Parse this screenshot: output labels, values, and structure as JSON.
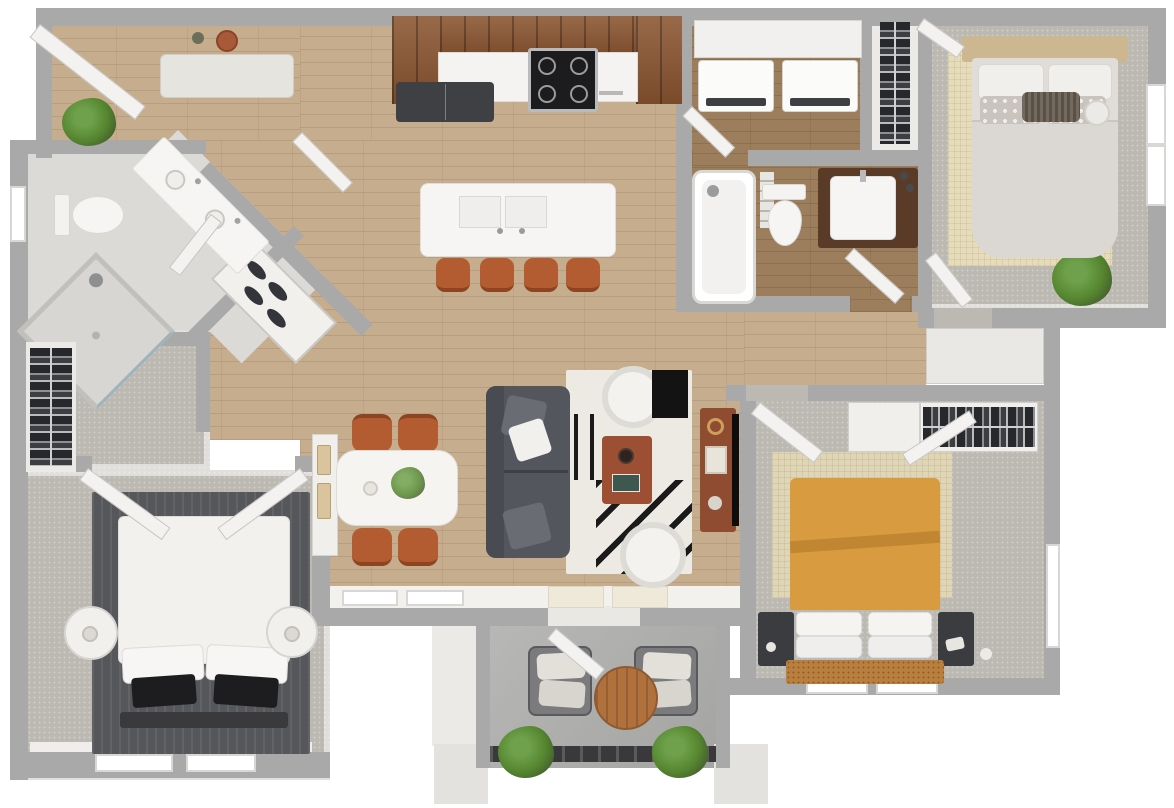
{
  "palette": {
    "wall": "#a9a9a9",
    "wood": "#c6ad8e",
    "woodDark": "#9c7e5d",
    "carpet": "#bcb8b2",
    "tile": "#dcdad6",
    "concrete": "#aeaeac",
    "cabinet": "#8a5530",
    "counter": "#f4f3f1",
    "stool": "#b45c31",
    "sofa": "#54565e",
    "rugLight": "#eceae3",
    "rugDark": "#55575b",
    "rugTan": "#e7dcba",
    "bedOrange": "#d99b40",
    "media": "#8f4c31",
    "plant": "#55862f",
    "plantLight": "#6fa04b",
    "plantDark": "#3c4a2c",
    "railing": "#39393b",
    "accentBlack": "#131313",
    "door": "#f3f2f0"
  },
  "apartment": {
    "type": "3-bedroom 2-bath apartment floor plan, 3D top-down render",
    "rooms": [
      {
        "id": "entry",
        "floor": "wood",
        "furniture": [
          "front-door",
          "entry-bench",
          "wall-hat-decor",
          "potted-plant"
        ]
      },
      {
        "id": "kitchen",
        "floor": "wood",
        "furniture": [
          "upper-cabinets",
          "refrigerator",
          "range-stove",
          "countertop",
          "island-with-double-sink",
          "bar-stool",
          "bar-stool",
          "bar-stool",
          "bar-stool"
        ]
      },
      {
        "id": "laundry",
        "floor": "wood-dark",
        "furniture": [
          "shelf",
          "washer",
          "dryer",
          "door"
        ]
      },
      {
        "id": "hall-closet",
        "floor": "white",
        "furniture": [
          "hanging-clothes-rack"
        ]
      },
      {
        "id": "bedroom-1",
        "floor": "carpet",
        "furniture": [
          "bed-gray",
          "headboard-tan",
          "patterned-pillows",
          "basket",
          "towel-roll",
          "tan-area-rug",
          "window",
          "potted-plant",
          "door"
        ]
      },
      {
        "id": "bathroom-2",
        "floor": "wood-dark",
        "furniture": [
          "bathtub-shower",
          "towel-shelf",
          "toilet",
          "dark-vanity-sink",
          "door"
        ]
      },
      {
        "id": "bathroom-1",
        "floor": "tile",
        "furniture": [
          "double-sink-vanity",
          "toilet",
          "corner-glass-shower",
          "linen-shelves",
          "window",
          "door"
        ]
      },
      {
        "id": "walk-in-closet",
        "floor": "carpet",
        "furniture": [
          "clothes-rack"
        ]
      },
      {
        "id": "bedroom-2",
        "floor": "carpet",
        "furniture": [
          "bed-white",
          "black-accent-pillows",
          "foot-bench",
          "round-nightstand",
          "round-nightstand",
          "dark-area-rug",
          "double-doors",
          "window",
          "window"
        ]
      },
      {
        "id": "living-room",
        "floor": "wood",
        "furniture": [
          "sofa-gray",
          "striped-area-rug",
          "barrel-chair",
          "barrel-chair",
          "coffee-table",
          "black-accent-table",
          "media-console",
          "tv",
          "window",
          "window"
        ]
      },
      {
        "id": "dining-area",
        "floor": "wood",
        "furniture": [
          "dining-table",
          "centerpiece-plant",
          "dining-chair",
          "dining-chair",
          "dining-chair",
          "dining-chair",
          "wall-console"
        ]
      },
      {
        "id": "bedroom-3",
        "floor": "carpet",
        "furniture": [
          "bed-orange",
          "woven-headboard",
          "nightstand",
          "nightstand",
          "tan-area-rug",
          "closet-with-clothes",
          "closet-door",
          "window",
          "window",
          "door"
        ]
      },
      {
        "id": "balcony",
        "floor": "concrete",
        "furniture": [
          "lounge-chair",
          "lounge-chair",
          "round-wood-table",
          "planter",
          "planter",
          "railing",
          "door"
        ]
      }
    ]
  }
}
